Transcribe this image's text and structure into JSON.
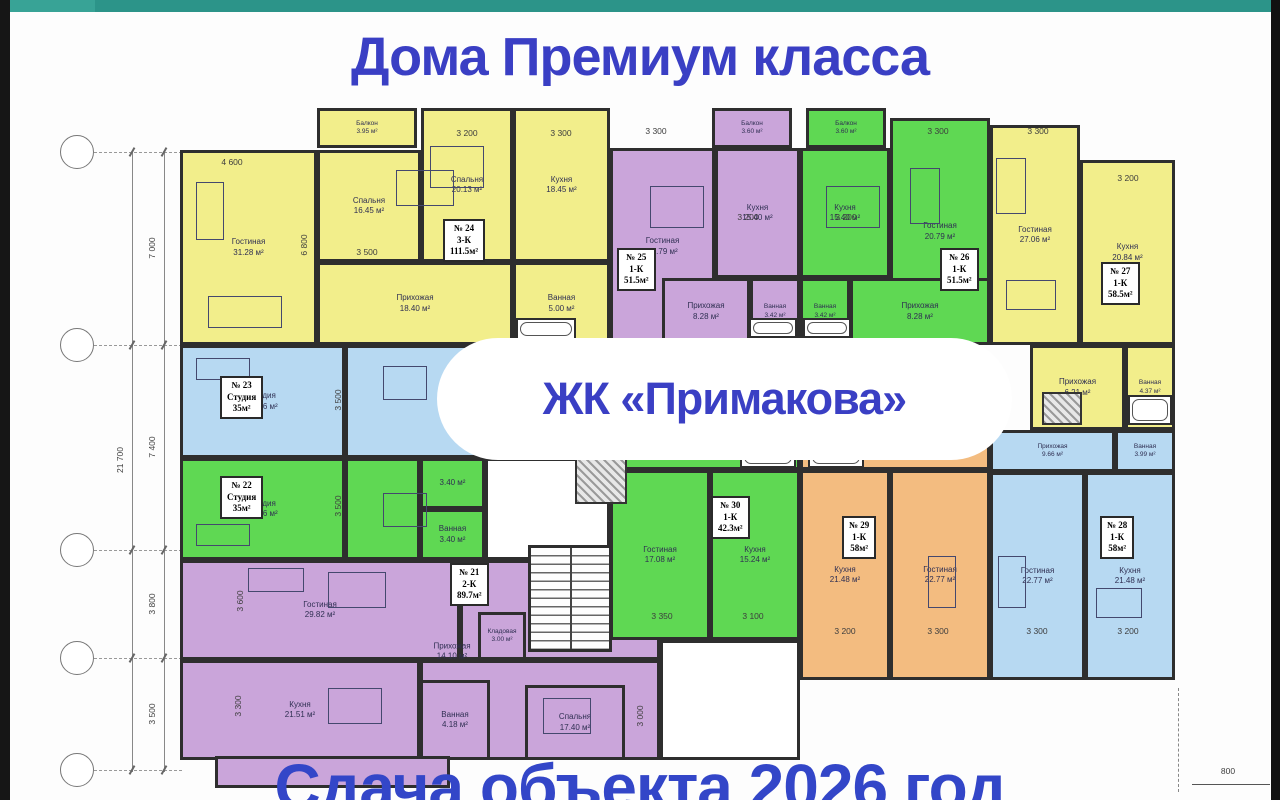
{
  "page": {
    "top_title": "Дома Премиум класса",
    "badge": "ЖК «Примакова»",
    "bottom_title": "Сдача объекта 2026 год"
  },
  "colors": {
    "accent_blue": "#3a3fc4",
    "teal_bar": "#2c9489",
    "wall": "#2e2e2e",
    "fills": {
      "y": "#f2ee8b",
      "p": "#caa5da",
      "g": "#5fd853",
      "b": "#b7d9f2",
      "o": "#f3bc80",
      "w": "#ffffff"
    }
  },
  "plan": {
    "apartments": [
      {
        "num": "№ 24",
        "type": "3-К",
        "area": "111.5м²",
        "x": 443,
        "y": 219
      },
      {
        "num": "№ 25",
        "type": "1-К",
        "area": "51.5м²",
        "x": 617,
        "y": 248
      },
      {
        "num": "№ 26",
        "type": "1-К",
        "area": "51.5м²",
        "x": 940,
        "y": 248
      },
      {
        "num": "№ 27",
        "type": "1-К",
        "area": "58.5м²",
        "x": 1101,
        "y": 262
      },
      {
        "num": "№ 23",
        "type": "Студия",
        "area": "35м²",
        "x": 220,
        "y": 376
      },
      {
        "num": "№ 22",
        "type": "Студия",
        "area": "35м²",
        "x": 220,
        "y": 476
      },
      {
        "num": "№ 21",
        "type": "2-К",
        "area": "89.7м²",
        "x": 450,
        "y": 563
      },
      {
        "num": "№ 30",
        "type": "1-К",
        "area": "42.3м²",
        "x": 711,
        "y": 496
      },
      {
        "num": "№ 29",
        "type": "1-К",
        "area": "58м²",
        "x": 842,
        "y": 516
      },
      {
        "num": "№ 28",
        "type": "1-К",
        "area": "58м²",
        "x": 1100,
        "y": 516
      }
    ],
    "rooms": [
      {
        "x": 317,
        "y": 108,
        "w": 100,
        "h": 40,
        "c": "y",
        "n": "Балкон",
        "a": "3.95 м²"
      },
      {
        "x": 180,
        "y": 150,
        "w": 137,
        "h": 195,
        "c": "y",
        "n": "Гостиная",
        "a": "31.28 м²"
      },
      {
        "x": 317,
        "y": 150,
        "w": 104,
        "h": 112,
        "c": "y",
        "n": "Спальня",
        "a": "16.45 м²"
      },
      {
        "x": 421,
        "y": 108,
        "w": 92,
        "h": 154,
        "c": "y",
        "n": "Спальня",
        "a": "20.13 м²"
      },
      {
        "x": 513,
        "y": 108,
        "w": 97,
        "h": 154,
        "c": "y",
        "n": "Кухня",
        "a": "18.45 м²"
      },
      {
        "x": 317,
        "y": 262,
        "w": 196,
        "h": 83,
        "c": "y",
        "n": "Прихожая",
        "a": "18.40 м²"
      },
      {
        "x": 513,
        "y": 262,
        "w": 97,
        "h": 83,
        "c": "y",
        "n": "Ванная",
        "a": "5.00 м²"
      },
      {
        "x": 712,
        "y": 108,
        "w": 80,
        "h": 40,
        "c": "p",
        "n": "Балкон",
        "a": "3.60 м²"
      },
      {
        "x": 610,
        "y": 148,
        "w": 105,
        "h": 197,
        "c": "p",
        "n": "Гостиная",
        "a": "20.79 м²"
      },
      {
        "x": 715,
        "y": 148,
        "w": 85,
        "h": 130,
        "c": "p",
        "n": "Кухня",
        "a": "15.40 м²"
      },
      {
        "x": 662,
        "y": 278,
        "w": 88,
        "h": 67,
        "c": "p",
        "n": "Прихожая",
        "a": "8.28 м²"
      },
      {
        "x": 750,
        "y": 278,
        "w": 50,
        "h": 67,
        "c": "p",
        "n": "Ванная",
        "a": "3.42 м²"
      },
      {
        "x": 806,
        "y": 108,
        "w": 80,
        "h": 40,
        "c": "g",
        "n": "Балкон",
        "a": "3.60 м²"
      },
      {
        "x": 800,
        "y": 148,
        "w": 90,
        "h": 130,
        "c": "g",
        "n": "Кухня",
        "a": "15.40 м²"
      },
      {
        "x": 890,
        "y": 118,
        "w": 100,
        "h": 227,
        "c": "g",
        "n": "Гостиная",
        "a": "20.79 м²"
      },
      {
        "x": 800,
        "y": 278,
        "w": 50,
        "h": 67,
        "c": "g",
        "n": "Ванная",
        "a": "3.42 м²"
      },
      {
        "x": 850,
        "y": 278,
        "w": 140,
        "h": 67,
        "c": "g",
        "n": "Прихожая",
        "a": "8.28 м²"
      },
      {
        "x": 990,
        "y": 125,
        "w": 90,
        "h": 220,
        "c": "y",
        "n": "Гостиная",
        "a": "27.06 м²"
      },
      {
        "x": 1080,
        "y": 160,
        "w": 95,
        "h": 185,
        "c": "y",
        "n": "Кухня",
        "a": "20.84 м²"
      },
      {
        "x": 1030,
        "y": 345,
        "w": 95,
        "h": 85,
        "c": "y",
        "n": "Прихожая",
        "a": "6.21 м²"
      },
      {
        "x": 1125,
        "y": 345,
        "w": 50,
        "h": 85,
        "c": "y",
        "n": "Ванная",
        "a": "4.37 м²"
      },
      {
        "x": 180,
        "y": 345,
        "w": 165,
        "h": 113,
        "c": "b",
        "n": "Студия",
        "a": "28.16 м²"
      },
      {
        "x": 345,
        "y": 345,
        "w": 185,
        "h": 113,
        "c": "b"
      },
      {
        "x": 530,
        "y": 345,
        "w": 80,
        "h": 113,
        "c": "b"
      },
      {
        "x": 180,
        "y": 458,
        "w": 165,
        "h": 102,
        "c": "g",
        "n": "Студия",
        "a": "28.16 м²"
      },
      {
        "x": 345,
        "y": 458,
        "w": 75,
        "h": 102,
        "c": "g"
      },
      {
        "x": 420,
        "y": 458,
        "w": 65,
        "h": 51,
        "c": "g",
        "a": "3.40 м²"
      },
      {
        "x": 420,
        "y": 509,
        "w": 65,
        "h": 51,
        "c": "g",
        "n": "Ванная",
        "a": "3.40 м²"
      },
      {
        "x": 485,
        "y": 458,
        "w": 125,
        "h": 102,
        "c": "w"
      },
      {
        "x": 180,
        "y": 560,
        "w": 280,
        "h": 100,
        "c": "p",
        "n": "Гостиная",
        "a": "29.82 м²"
      },
      {
        "x": 180,
        "y": 660,
        "w": 240,
        "h": 100,
        "c": "p",
        "n": "Кухня",
        "a": "21.51 м²"
      },
      {
        "x": 460,
        "y": 560,
        "w": 200,
        "h": 100,
        "c": "p"
      },
      {
        "x": 420,
        "y": 660,
        "w": 240,
        "h": 100,
        "c": "p"
      },
      {
        "x": 420,
        "y": 680,
        "w": 70,
        "h": 80,
        "c": "p",
        "n": "Ванная",
        "a": "4.18 м²"
      },
      {
        "x": 525,
        "y": 685,
        "w": 100,
        "h": 75,
        "c": "p",
        "n": "Спальня",
        "a": "17.40 м²"
      },
      {
        "x": 478,
        "y": 612,
        "w": 48,
        "h": 48,
        "c": "p",
        "n": "Кладовая",
        "a": "3.00 м²"
      },
      {
        "x": 660,
        "y": 640,
        "w": 140,
        "h": 120,
        "c": "w"
      },
      {
        "x": 610,
        "y": 440,
        "w": 190,
        "h": 30,
        "c": "g",
        "a": "6.19 м²"
      },
      {
        "x": 610,
        "y": 470,
        "w": 100,
        "h": 170,
        "c": "g",
        "n": "Гостиная",
        "a": "17.08 м²"
      },
      {
        "x": 710,
        "y": 470,
        "w": 90,
        "h": 170,
        "c": "g",
        "n": "Кухня",
        "a": "15.24 м²"
      },
      {
        "x": 800,
        "y": 440,
        "w": 190,
        "h": 30,
        "c": "o",
        "a": "9.66 м²"
      },
      {
        "x": 800,
        "y": 470,
        "w": 90,
        "h": 210,
        "c": "o",
        "n": "Кухня",
        "a": "21.48 м²"
      },
      {
        "x": 890,
        "y": 470,
        "w": 100,
        "h": 210,
        "c": "o",
        "n": "Гостиная",
        "a": "22.77 м²"
      },
      {
        "x": 990,
        "y": 430,
        "w": 125,
        "h": 42,
        "c": "b",
        "n": "Прихожая",
        "a": "9.66 м²"
      },
      {
        "x": 1115,
        "y": 430,
        "w": 60,
        "h": 42,
        "c": "b",
        "n": "Ванная",
        "a": "3.99 м²"
      },
      {
        "x": 990,
        "y": 472,
        "w": 95,
        "h": 208,
        "c": "b",
        "n": "Гостиная",
        "a": "22.77 м²"
      },
      {
        "x": 1085,
        "y": 472,
        "w": 90,
        "h": 208,
        "c": "b",
        "n": "Кухня",
        "a": "21.48 м²"
      },
      {
        "x": 215,
        "y": 756,
        "w": 235,
        "h": 32,
        "c": "p"
      }
    ],
    "free_labels": [
      {
        "n": "Прихожая",
        "a": "14.10 м²",
        "x": 452,
        "y": 652
      }
    ],
    "dims": [
      {
        "t": "4 600",
        "x": 232,
        "y": 162
      },
      {
        "t": "3 500",
        "x": 367,
        "y": 252
      },
      {
        "t": "3 200",
        "x": 467,
        "y": 133
      },
      {
        "t": "3 300",
        "x": 561,
        "y": 133
      },
      {
        "t": "6 800",
        "x": 304,
        "y": 245,
        "v": 1
      },
      {
        "t": "3 300",
        "x": 656,
        "y": 131
      },
      {
        "t": "3 200",
        "x": 748,
        "y": 217
      },
      {
        "t": "3 200",
        "x": 846,
        "y": 217
      },
      {
        "t": "3 300",
        "x": 938,
        "y": 131
      },
      {
        "t": "3 300",
        "x": 1038,
        "y": 131
      },
      {
        "t": "3 200",
        "x": 1128,
        "y": 178
      },
      {
        "t": "3 500",
        "x": 338,
        "y": 400,
        "v": 1
      },
      {
        "t": "3 500",
        "x": 338,
        "y": 506,
        "v": 1
      },
      {
        "t": "3 600",
        "x": 240,
        "y": 601,
        "v": 1
      },
      {
        "t": "3 300",
        "x": 238,
        "y": 706,
        "v": 1
      },
      {
        "t": "3 000",
        "x": 640,
        "y": 716,
        "v": 1
      },
      {
        "t": "3 350",
        "x": 662,
        "y": 616
      },
      {
        "t": "3 100",
        "x": 753,
        "y": 616
      },
      {
        "t": "3 200",
        "x": 845,
        "y": 631
      },
      {
        "t": "3 300",
        "x": 938,
        "y": 631
      },
      {
        "t": "3 300",
        "x": 1037,
        "y": 631
      },
      {
        "t": "3 200",
        "x": 1128,
        "y": 631
      },
      {
        "t": "800",
        "x": 1228,
        "y": 771
      },
      {
        "t": "21 700",
        "x": 120,
        "y": 460,
        "v": 1
      },
      {
        "t": "7 000",
        "x": 152,
        "y": 248,
        "v": 1
      },
      {
        "t": "7 400",
        "x": 152,
        "y": 447,
        "v": 1
      },
      {
        "t": "3 800",
        "x": 152,
        "y": 604,
        "v": 1
      },
      {
        "t": "3 500",
        "x": 152,
        "y": 714,
        "v": 1
      }
    ],
    "stairs": {
      "x": 528,
      "y": 545,
      "w": 84,
      "h": 107
    },
    "shafts": [
      {
        "x": 575,
        "y": 456,
        "w": 52,
        "h": 48
      },
      {
        "x": 1042,
        "y": 392,
        "w": 40,
        "h": 33
      }
    ],
    "tubs": [
      {
        "x": 740,
        "y": 442,
        "w": 56,
        "h": 26
      },
      {
        "x": 808,
        "y": 442,
        "w": 56,
        "h": 26
      },
      {
        "x": 1128,
        "y": 395,
        "w": 44,
        "h": 30
      },
      {
        "x": 516,
        "y": 318,
        "w": 60,
        "h": 22
      },
      {
        "x": 749,
        "y": 318,
        "w": 48,
        "h": 20
      },
      {
        "x": 803,
        "y": 318,
        "w": 48,
        "h": 20
      }
    ],
    "furniture": [
      {
        "x": 196,
        "y": 182,
        "w": 28,
        "h": 58
      },
      {
        "x": 208,
        "y": 296,
        "w": 74,
        "h": 32
      },
      {
        "x": 396,
        "y": 170,
        "w": 58,
        "h": 36
      },
      {
        "x": 430,
        "y": 146,
        "w": 54,
        "h": 42
      },
      {
        "x": 650,
        "y": 186,
        "w": 54,
        "h": 42
      },
      {
        "x": 826,
        "y": 186,
        "w": 54,
        "h": 42
      },
      {
        "x": 910,
        "y": 168,
        "w": 30,
        "h": 56
      },
      {
        "x": 996,
        "y": 158,
        "w": 30,
        "h": 56
      },
      {
        "x": 1006,
        "y": 280,
        "w": 50,
        "h": 30
      },
      {
        "x": 196,
        "y": 358,
        "w": 54,
        "h": 22
      },
      {
        "x": 383,
        "y": 366,
        "w": 44,
        "h": 34
      },
      {
        "x": 196,
        "y": 524,
        "w": 54,
        "h": 22
      },
      {
        "x": 383,
        "y": 493,
        "w": 44,
        "h": 34
      },
      {
        "x": 248,
        "y": 568,
        "w": 56,
        "h": 24
      },
      {
        "x": 328,
        "y": 572,
        "w": 58,
        "h": 36
      },
      {
        "x": 328,
        "y": 688,
        "w": 54,
        "h": 36
      },
      {
        "x": 543,
        "y": 698,
        "w": 48,
        "h": 36
      },
      {
        "x": 928,
        "y": 556,
        "w": 28,
        "h": 52
      },
      {
        "x": 998,
        "y": 556,
        "w": 28,
        "h": 52
      },
      {
        "x": 1096,
        "y": 588,
        "w": 46,
        "h": 30
      }
    ],
    "axis": {
      "cx": 77,
      "circles_y": [
        152,
        345,
        550,
        658,
        770
      ],
      "lines": [
        {
          "x": 132,
          "y1": 150,
          "y2": 772
        },
        {
          "x": 164,
          "y1": 150,
          "y2": 772
        }
      ],
      "overall_dim": "21 700",
      "segment_dims": [
        "7 000",
        "7 400",
        "3 800",
        "3 500"
      ],
      "bottom_dim": "800"
    },
    "extra_lines": [
      {
        "cls": "hline",
        "x": 1192,
        "y": 784,
        "w": 78,
        "h": 0
      },
      {
        "cls": "vdash",
        "x": 1178,
        "y": 688,
        "w": 0,
        "h": 104
      }
    ]
  }
}
